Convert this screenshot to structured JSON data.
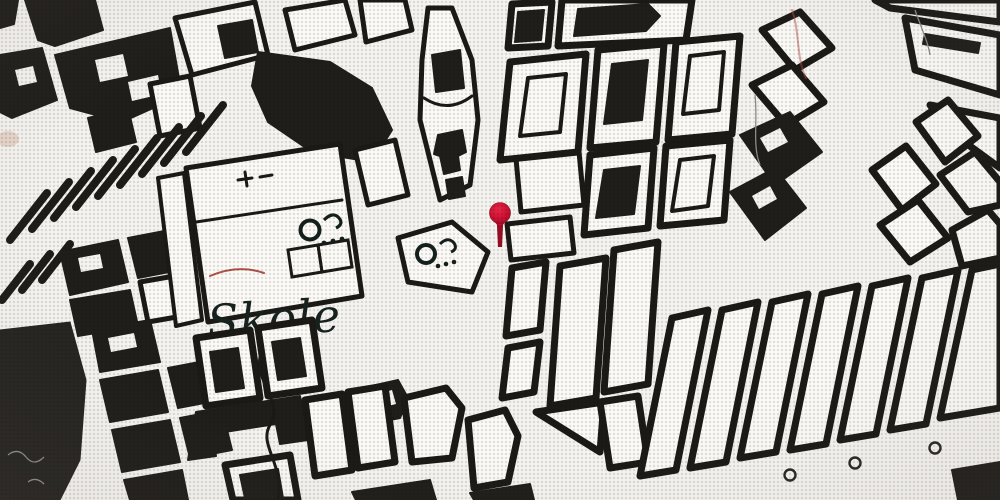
{
  "map": {
    "kind": "vintage-monochrome-city-map",
    "labels": [
      {
        "text": "Skole",
        "x": 208,
        "y": 338,
        "style": "italic-serif"
      }
    ],
    "marker": {
      "name": "location-pin",
      "x": 500,
      "y": 214,
      "head_color": "#d01332",
      "stem_color": "#9a0e24"
    },
    "symbols": [
      {
        "name": "monument-ring-symbol",
        "x": 310,
        "y": 230
      },
      {
        "name": "monument-ring-symbol",
        "x": 428,
        "y": 252
      }
    ],
    "railway": {
      "name": "railway-line",
      "loop_count": 3
    },
    "colors": {
      "paper": "#f6f4f1",
      "ink": "#1b1a17",
      "block_fill": "#fbfaf7",
      "dark_fill": "#262421",
      "contour_red": "#b05248"
    }
  }
}
